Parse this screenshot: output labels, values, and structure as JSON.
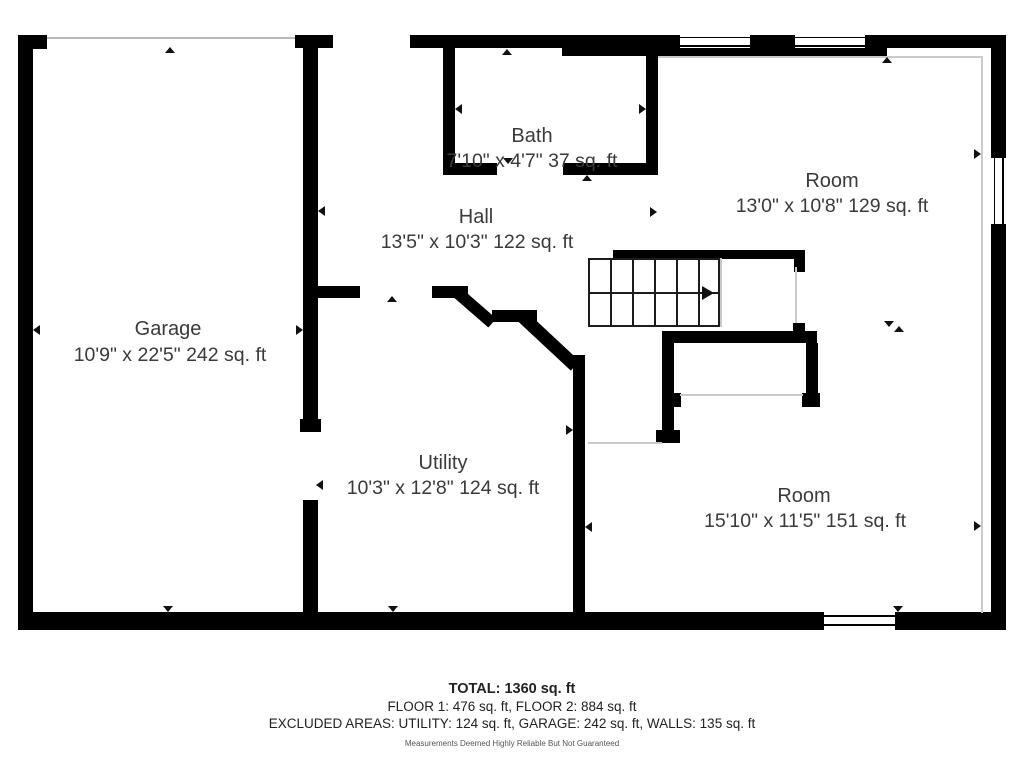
{
  "title": "Floor plan",
  "rooms": {
    "garage": {
      "name": "Garage",
      "dims": "10'9\" x 22'5\" 242 sq. ft"
    },
    "bath": {
      "name": "Bath",
      "dims": "7'10\" x 4'7\" 37 sq. ft"
    },
    "hall": {
      "name": "Hall",
      "dims": "13'5\" x 10'3\" 122 sq. ft"
    },
    "room_upper": {
      "name": "Room",
      "dims": "13'0\" x 10'8\" 129 sq. ft"
    },
    "utility": {
      "name": "Utility",
      "dims": "10'3\" x 12'8\" 124 sq. ft"
    },
    "room_lower": {
      "name": "Room",
      "dims": "15'10\" x 11'5\" 151 sq. ft"
    }
  },
  "summary": {
    "total": "TOTAL: 1360 sq. ft",
    "floors": "FLOOR 1: 476 sq. ft, FLOOR 2: 884 sq. ft",
    "excluded": "EXCLUDED AREAS: UTILITY: 124 sq. ft, GARAGE: 242 sq. ft, WALLS: 135 sq. ft",
    "disclaimer": "Measurements Deemed Highly Reliable But Not Guaranteed"
  },
  "colors": {
    "wall": "#000000",
    "text": "#3a3a3a",
    "thin_line": "#c9c9c9",
    "door_line": "#b8b8b8"
  }
}
